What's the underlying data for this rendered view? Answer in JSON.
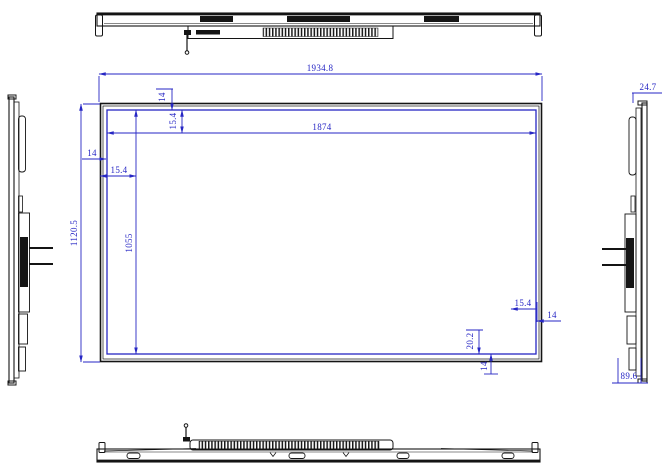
{
  "drawing": {
    "type": "display-panel-technical-drawing",
    "colors": {
      "dimension": "#2626c4",
      "outline": "#141414",
      "background": "#ffffff"
    },
    "front": {
      "outer_width": "1934.8",
      "outer_height": "1120.5",
      "active_width": "1874",
      "active_height": "1055",
      "top_inset": "14",
      "top_bezel": "15.4",
      "left_inset": "14",
      "left_bezel": "15.4",
      "right_bezel": "15.4",
      "right_inset": "14",
      "bottom_bezel": "20.2",
      "bottom_inset": "14"
    },
    "side": {
      "front_depth": "24.7",
      "total_depth": "89.6"
    }
  }
}
